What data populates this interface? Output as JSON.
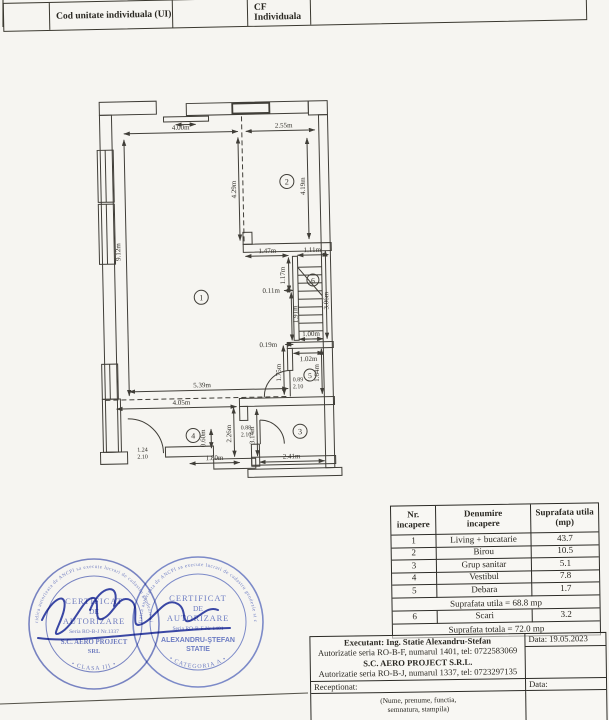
{
  "header": {
    "cod_label": "Cod unitate individuala (UI)",
    "cf_label": "CF Individuala"
  },
  "plan": {
    "rooms": [
      {
        "n": "1"
      },
      {
        "n": "2"
      },
      {
        "n": "3"
      },
      {
        "n": "4"
      },
      {
        "n": "5"
      },
      {
        "n": "6"
      }
    ],
    "dims": {
      "w400": "4.00m",
      "w255": "2.55m",
      "v429": "4.29m",
      "v419": "4.19m",
      "v912": "9.12m",
      "w147": "1.47m",
      "w111": "1.11m",
      "v117": "1.17m",
      "w011": "0.11m",
      "v191": "1.91m",
      "v306": "3.06m",
      "w100": "1.00m",
      "w019": "0.19m",
      "w102": "1.02m",
      "v175": "1.75m",
      "v164": "1.64m",
      "w539": "5.39m",
      "w405": "4.05m",
      "v060": "0.60m",
      "v226": "2.26m",
      "v314": "3.14m",
      "w180": "1.80m",
      "w241": "2.41m"
    },
    "doors": {
      "d4w": "1.24",
      "d4h": "2.10",
      "d5w": "0.89",
      "d5h": "2.10",
      "d3w": "0.88",
      "d3h": "2.10"
    }
  },
  "area_table": {
    "headers": [
      {
        "l1": "Nr.",
        "l2": "incapere"
      },
      {
        "l1": "Denumire",
        "l2": "incapere"
      },
      {
        "l1": "Suprafata utila",
        "l2": "(mp)"
      }
    ],
    "rows": [
      [
        "1",
        "Living + bucatarie",
        "43.7"
      ],
      [
        "2",
        "Birou",
        "10.5"
      ],
      [
        "3",
        "Grup sanitar",
        "5.1"
      ],
      [
        "4",
        "Vestibul",
        "7.8"
      ],
      [
        "5",
        "Debara",
        "1.7"
      ]
    ],
    "subtotal": "Suprafata utila = 68.8 mp",
    "row6": [
      "6",
      "Scari",
      "3.2"
    ],
    "total": "Suprafata totala = 72.0 mp"
  },
  "executant": {
    "line1": "Executant: Ing. Statie Alexandru-Stefan",
    "line2": "Autorizatie seria RO-B-F, numarul 1401, tel: 0722583069",
    "line3": "S.C. AERO PROJECT S.R.L.",
    "line4": "Autorizatie seria RO-B-J, numarul 1337, tel: 0723297135",
    "data1": "Data: 19.05.2023",
    "receptionat": "Receptionat:",
    "data2": "Data:",
    "note1": "(Nume, prenume, functia,",
    "note2": "semnatura, stampila)"
  },
  "stamps": {
    "stamp1": {
      "t1": "CERTIFICAT",
      "t2": "DE",
      "t3": "AUTORIZARE",
      "t4": "Seria RO-B-J Nr.1337",
      "t5": "S.C. AERO PROJECT",
      "t6": "SRL",
      "bottom": "• CLASA III •",
      "rim": "Persoana juridica autorizata de ANCPI sa execute lucrari de cadastru geodezie si cartografie"
    },
    "stamp2": {
      "t1": "CERTIFICAT",
      "t2": "DE",
      "t3": "AUTORIZARE",
      "t4": "Seria RO-B-F Nr 1401",
      "t5": "ALEXANDRU-ŞTEFAN",
      "t6": "STATIE",
      "bottom": "• CATEGORIA A •",
      "rim": "Persoana fizica autorizata de ANCPI sa execute lucrari de cadastru geodezie si cartografie"
    }
  },
  "colors": {
    "stamp_blue": "#4456b8",
    "stamp_blue2": "#4c61c2",
    "signature_blue": "#2737a6",
    "ink": "#3a382f"
  }
}
